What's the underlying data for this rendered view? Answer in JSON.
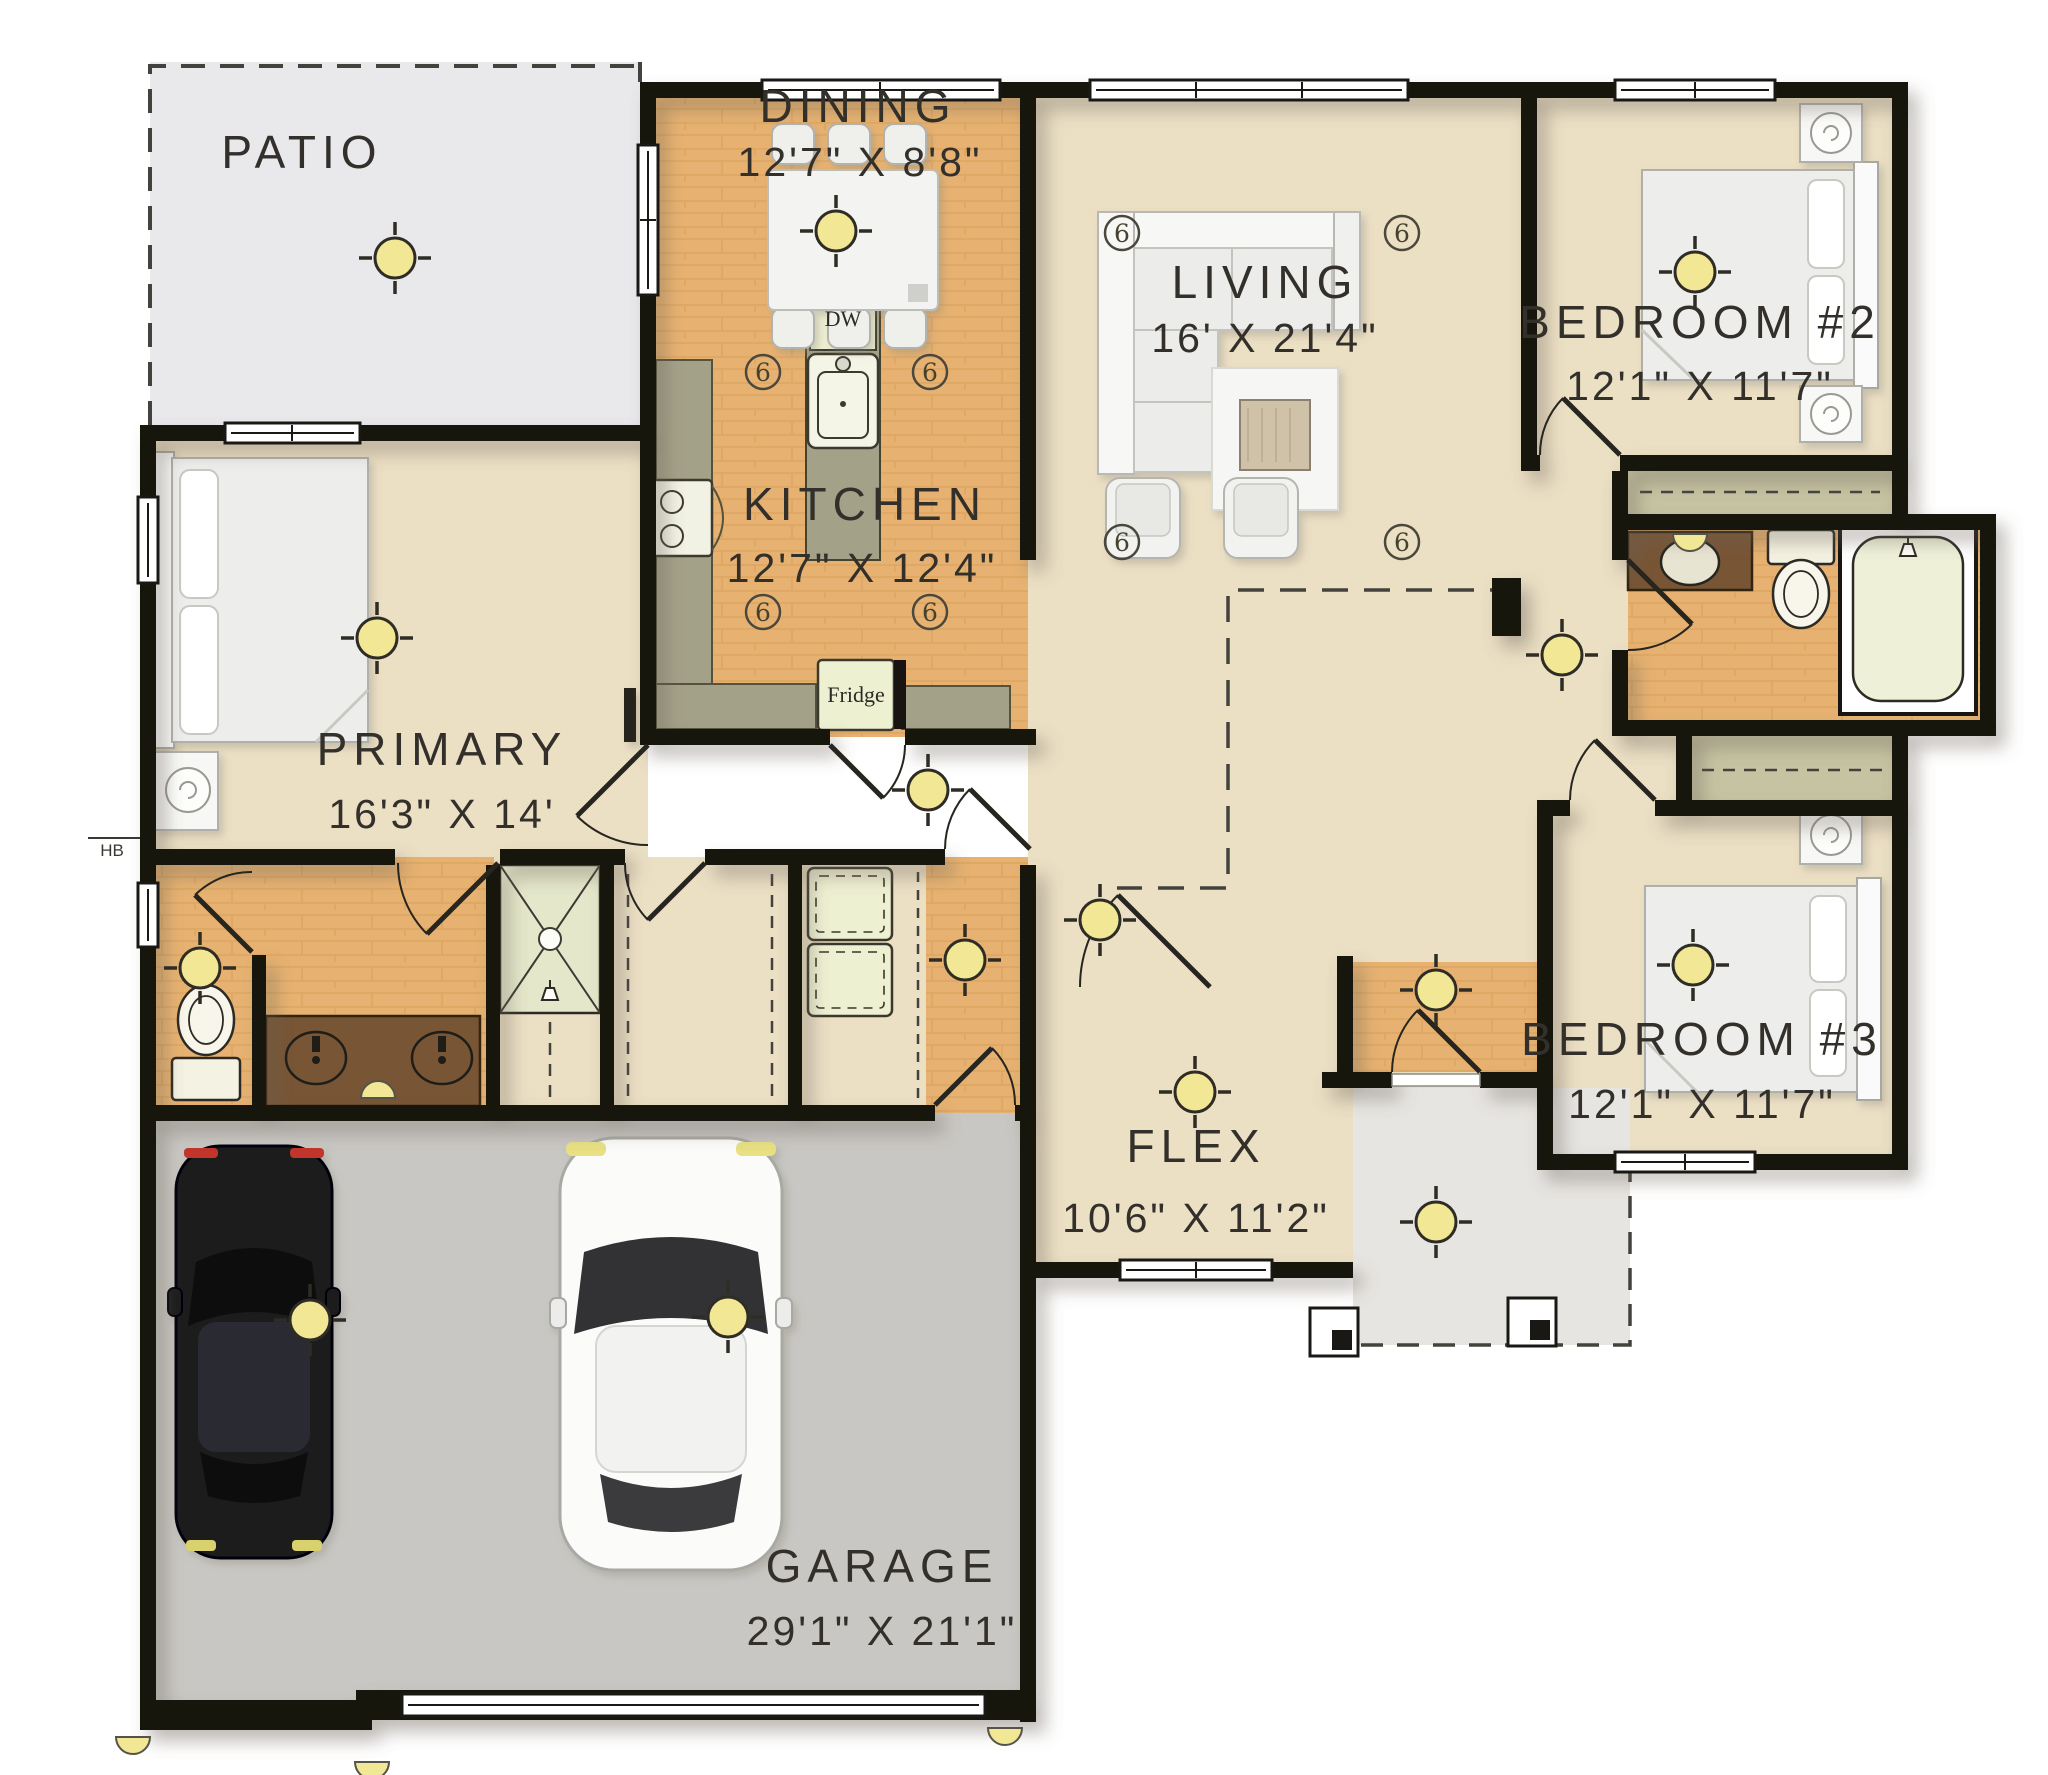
{
  "plan": {
    "title": "Single-story floor plan",
    "rooms": [
      {
        "id": "patio",
        "label": "PATIO",
        "dims": ""
      },
      {
        "id": "dining",
        "label": "DINING",
        "dims": "12'7\" X 8'8\""
      },
      {
        "id": "living",
        "label": "LIVING",
        "dims": "16' X 21'4\""
      },
      {
        "id": "bedroom2",
        "label": "BEDROOM #2",
        "dims": "12'1\" X 11'7\""
      },
      {
        "id": "kitchen",
        "label": "KITCHEN",
        "dims": "12'7\" X 12'4\""
      },
      {
        "id": "primary",
        "label": "PRIMARY",
        "dims": "16'3\" X 14'"
      },
      {
        "id": "bedroom3",
        "label": "BEDROOM #3",
        "dims": "12'1\" X 11'7\""
      },
      {
        "id": "flex",
        "label": "FLEX",
        "dims": "10'6\" X 11'2\""
      },
      {
        "id": "garage",
        "label": "GARAGE",
        "dims": "29'1\" X 21'1\""
      }
    ],
    "fixtures": {
      "dishwasher": "DW",
      "fridge": "Fridge",
      "hose_bib": "HB"
    },
    "palette": {
      "wall": "#171411",
      "beige": "#ebdfc4",
      "wood": "#e7b271",
      "woodline": "#d0964e",
      "patio": "#e9e9ec",
      "porch": "#e7e5e2",
      "garage": "#c9c7c3",
      "counter": "#a3a188",
      "appliance": "#eef0d2",
      "vanity": "#775535",
      "shower": "#e4e7ca",
      "tub": "#eef0d8",
      "closet": "#c6c3a2",
      "light": "#f2e795",
      "furniture": "#f2f2f2",
      "text": "#33302b"
    },
    "symbols": {
      "ceiling_lights": [
        {
          "x": 395,
          "y": 258
        },
        {
          "x": 836,
          "y": 231
        },
        {
          "x": 377,
          "y": 638
        },
        {
          "x": 1695,
          "y": 272
        },
        {
          "x": 1693,
          "y": 965
        },
        {
          "x": 1562,
          "y": 655
        },
        {
          "x": 200,
          "y": 968
        },
        {
          "x": 965,
          "y": 960
        },
        {
          "x": 928,
          "y": 790
        },
        {
          "x": 1100,
          "y": 920
        },
        {
          "x": 1436,
          "y": 990
        },
        {
          "x": 1195,
          "y": 1092
        },
        {
          "x": 1436,
          "y": 1222
        },
        {
          "x": 310,
          "y": 1320
        },
        {
          "x": 728,
          "y": 1317
        }
      ],
      "recessed_lights": [
        {
          "x": 1122,
          "y": 233
        },
        {
          "x": 1402,
          "y": 233
        },
        {
          "x": 1122,
          "y": 542
        },
        {
          "x": 1402,
          "y": 542
        },
        {
          "x": 763,
          "y": 372
        },
        {
          "x": 930,
          "y": 372
        },
        {
          "x": 763,
          "y": 612
        },
        {
          "x": 930,
          "y": 612
        }
      ],
      "sconces": [
        {
          "x": 378,
          "y": 1098,
          "dir": "up"
        },
        {
          "x": 1690,
          "y": 534,
          "dir": "down"
        },
        {
          "x": 133,
          "y": 1737,
          "dir": "down"
        },
        {
          "x": 372,
          "y": 1762,
          "dir": "down"
        },
        {
          "x": 1005,
          "y": 1728,
          "dir": "down"
        }
      ]
    }
  }
}
